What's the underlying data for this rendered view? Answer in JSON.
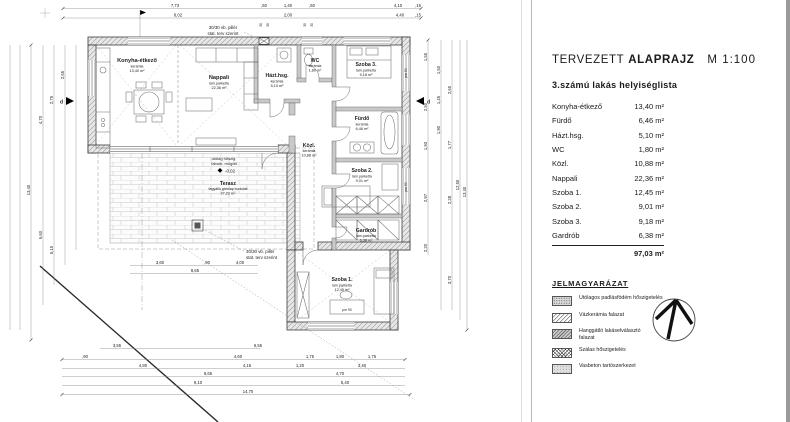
{
  "panel": {
    "title_left": "TERVEZETT",
    "title_bold": "ALAPRAJZ",
    "title_scale": "M 1:100",
    "subtitle": "3.számú lakás helyiséglista",
    "rooms": [
      {
        "name": "Konyha-étkező",
        "area": "13,40 m²"
      },
      {
        "name": "Fürdő",
        "area": "6,46 m²"
      },
      {
        "name": "Házt.hsg.",
        "area": "5,10 m²"
      },
      {
        "name": "WC",
        "area": "1,80 m²"
      },
      {
        "name": "Közl.",
        "area": "10,88 m²"
      },
      {
        "name": "Nappali",
        "area": "22,36 m²"
      },
      {
        "name": "Szoba 1.",
        "area": "12,45 m²"
      },
      {
        "name": "Szoba 2.",
        "area": "9,01 m²"
      },
      {
        "name": "Szoba 3.",
        "area": "9,18 m²"
      },
      {
        "name": "Gardrób",
        "area": "6,38 m²"
      }
    ],
    "total": "97,03 m²",
    "legend": {
      "title": "JELMAGYARÁZAT",
      "items": [
        "Utólagos padlásfödém hőszigetelés",
        "Vázkerámia falazat",
        "Hanggátló lakáselválasztó\nfalazat",
        "Szálas hőszigetelés",
        "Vasbeton tartószerkezet"
      ]
    }
  },
  "plan": {
    "rooms": {
      "konyha": {
        "name": "Konyha-étkező",
        "floor": "kerámia",
        "area": "13,40 m²"
      },
      "nappali": {
        "name": "Nappali",
        "floor": "lam.parketta",
        "area": "22,36 m²"
      },
      "hazthsg": {
        "name": "Házt.hsg.",
        "floor": "kerámia",
        "area": "5,10 m²"
      },
      "wc": {
        "name": "WC",
        "floor": "kerámia",
        "area": "1,80 m²"
      },
      "szoba3": {
        "name": "Szoba 3.",
        "floor": "lam.parketta",
        "area": "9,18 m²"
      },
      "furdo": {
        "name": "Fürdő",
        "floor": "kerámia",
        "area": "6,46 m²"
      },
      "kozl": {
        "name": "Közl.",
        "floor": "kerámia",
        "area": "10,88 m²"
      },
      "szoba2": {
        "name": "Szoba 2.",
        "floor": "lam.parketta",
        "area": "9,01 m²"
      },
      "gardrob": {
        "name": "Gardrób",
        "floor": "lam.parketta",
        "area": "6,38 m²"
      },
      "szoba1": {
        "name": "Szoba 1.",
        "floor": "lam.parketta",
        "area": "12,45 m²"
      },
      "terasz": {
        "name": "Terasz",
        "floor": "fagyálló greslap burkolat",
        "area": "27,22 m²"
      }
    },
    "notes": {
      "pillar_line1": "30/30 vb. pillér",
      "pillar_line2": "stat. terv szerint",
      "insul_line1": "utólag hőszig.",
      "insul_line2": "faburk. mögött",
      "level": "-0,02",
      "section_label": "d",
      "sill_label": "pm 90"
    },
    "dims": {
      "top1": [
        "7,73",
        ",60",
        "1,40",
        ",60",
        "4,10",
        ",15"
      ],
      "top2": [
        "8,02",
        "2,00",
        "4,40",
        ",15"
      ],
      "pillar_ticks": [
        "30",
        "30",
        "30",
        "30"
      ],
      "mid1": [
        "3,60",
        ",90",
        "4,00"
      ],
      "mid2": [
        "8,65"
      ],
      "bot0": [
        "3,55",
        "6,55"
      ],
      "bot1": [
        ",90",
        "4,60",
        "1,75",
        "1,80",
        "1,75"
      ],
      "bot2": [
        "4,80",
        "4,15",
        "1,20",
        "3,40"
      ],
      "bot3": [
        "8,65",
        "4,70"
      ],
      "bot4": [
        "9,10",
        "5,40"
      ],
      "bot5": [
        "14,70"
      ],
      "left": [
        "13,40",
        "4,70",
        "6,60",
        "2,75",
        "5,15",
        "2,65"
      ],
      "right": [
        "1,55",
        "2,50",
        "1,93",
        "2,97",
        "2,20",
        "1,50",
        "1,45",
        "1,90",
        "2,65",
        "1,77",
        "2,28",
        "3,70",
        "12,50",
        "13,40"
      ]
    }
  }
}
